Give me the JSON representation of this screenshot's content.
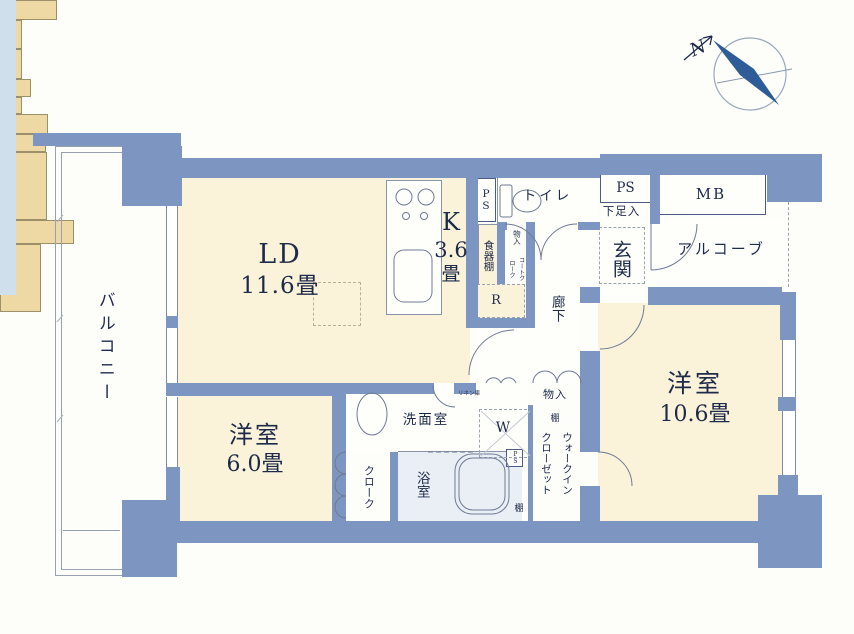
{
  "compass": {
    "north": "N"
  },
  "rooms": {
    "balcony": "バルコニー",
    "living_dining": "LD",
    "living_dining_size": "11.6畳",
    "kitchen": "K",
    "kitchen_size": "3.6",
    "kitchen_size_unit": "畳",
    "western_room_6": "洋室",
    "western_room_6_size": "6.0畳",
    "western_room_10": "洋室",
    "western_room_10_size": "10.6畳",
    "washroom": "洗面室",
    "bathroom": "浴室",
    "toilet": "トイレ",
    "entrance": "玄関",
    "hallway": "廊下",
    "alcove": "アルコーブ"
  },
  "storage": {
    "ps_kitchen": "PS",
    "ps_entrance": "PS",
    "ps_utility": "PS",
    "meter_box": "MB",
    "shoe_cabinet": "下足入",
    "dish_shelf": "食器棚",
    "hallway_storage": "物入",
    "coat_cloak": "コートクローク",
    "refrigerator_space": "R",
    "bedroom_storage": "物入",
    "shelf_upper": "棚",
    "shelf_lower": "棚",
    "walk_in_closet": "ウォークインクローゼット",
    "cloak": "クローク",
    "linen_cabinet": "リネン庫",
    "washer_space": "W"
  },
  "colors": {
    "wall": "#7d96c1",
    "room_floor": "#faf3d9",
    "storage_fill": "#eed9a4",
    "bathroom_fill": "#e9eff5",
    "label_text": "#1e2a4a",
    "compass_needle": "#2e5c99"
  }
}
